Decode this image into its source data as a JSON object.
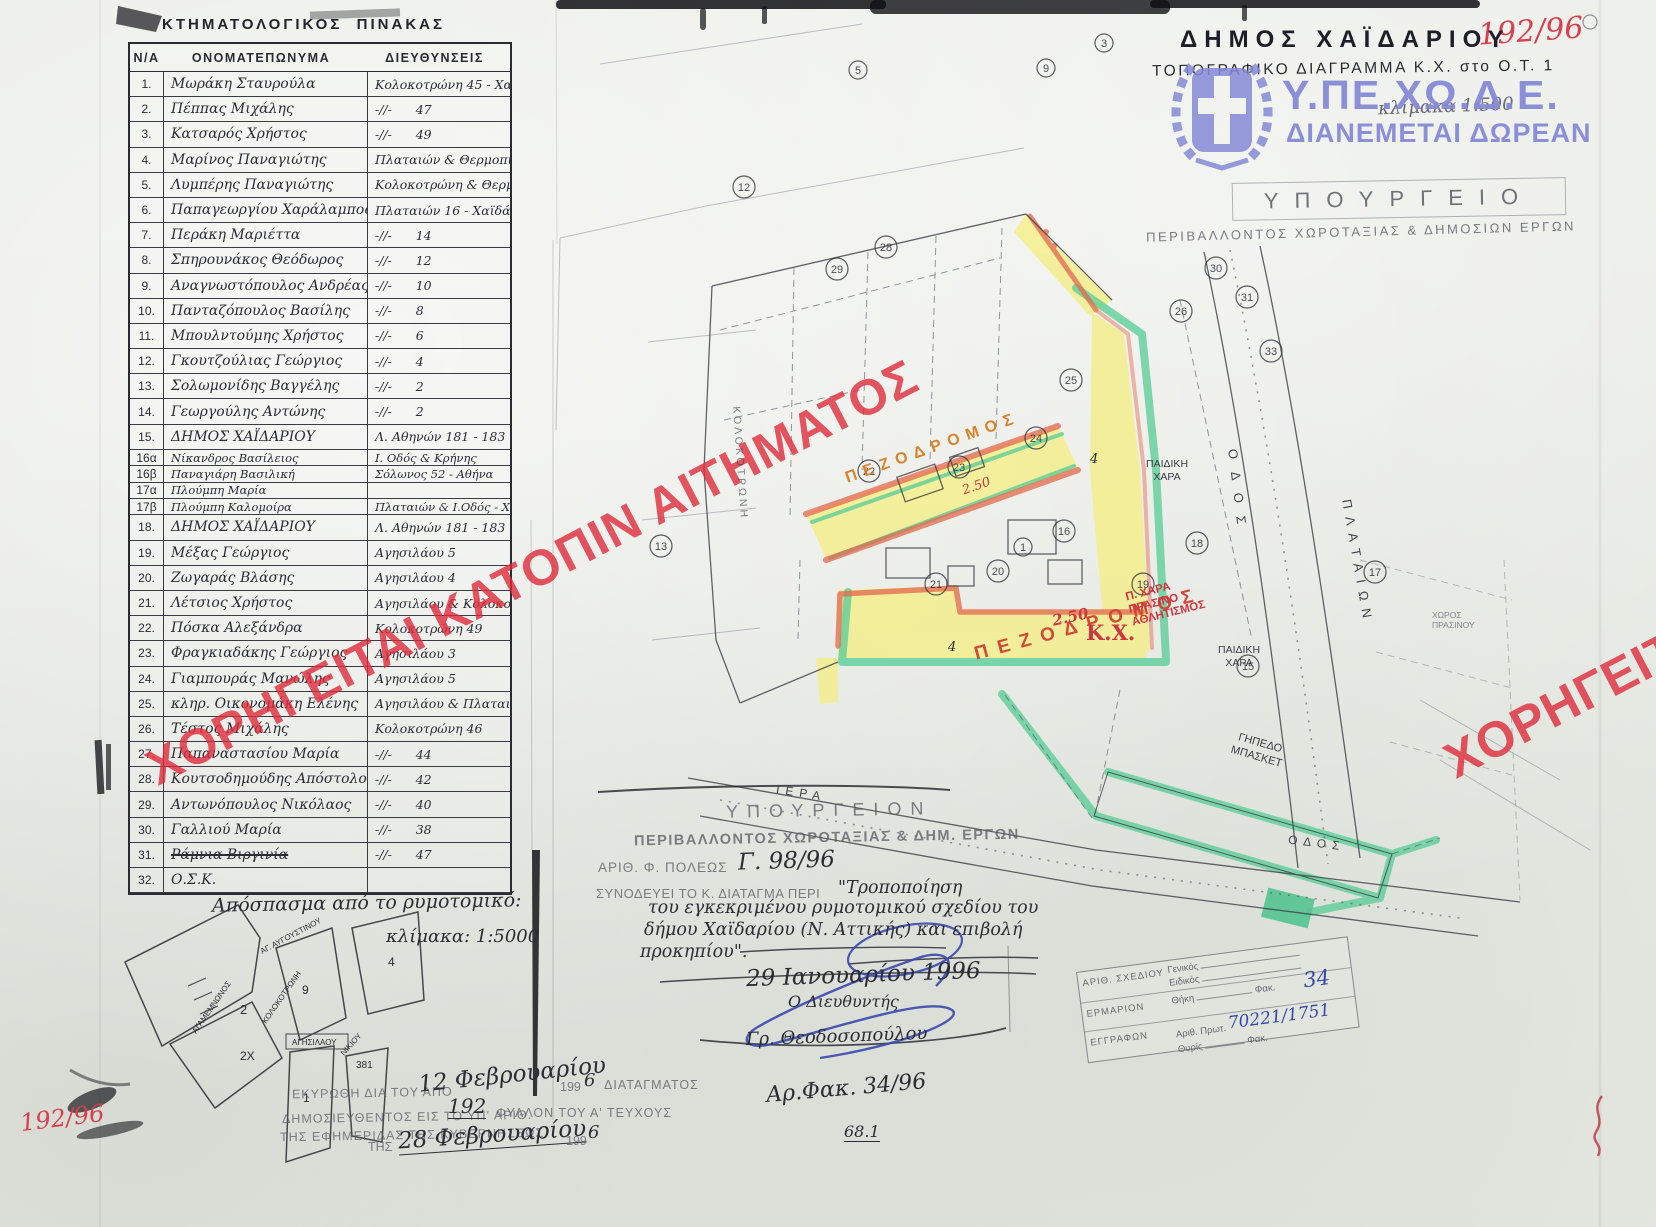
{
  "page": {
    "corner_number_top_right": "192/96",
    "corner_number_bottom_left": "192/96"
  },
  "table": {
    "title": "ΚΤΗΜΑΤΟΛΟΓΙΚΟΣ  ΠΙΝΑΚΑΣ",
    "columns": [
      "Ν/Α",
      "ΟΝΟΜΑΤΕΠΩΝΥΜΑ",
      "ΔΙΕΥΘΥΝΣΕΙΣ"
    ],
    "rows": [
      {
        "num": "1.",
        "name": "Μωράκη Σταυρούλα",
        "addr": "Κολοκοτρώνη 45 - Χαϊδάρι"
      },
      {
        "num": "2.",
        "name": "Πέππας Μιχάλης",
        "addr": "-//-      47"
      },
      {
        "num": "3.",
        "name": "Κατσαρός Χρήστος",
        "addr": "-//-      49"
      },
      {
        "num": "4.",
        "name": "Μαρίνος Παναγιώτης",
        "addr": "Πλαταιών & Θερμοπυλών"
      },
      {
        "num": "5.",
        "name": "Λυμπέρης Παναγιώτης",
        "addr": "Κολοκοτρώνη & Θερμοπυλών 3"
      },
      {
        "num": "6.",
        "name": "Παπαγεωργίου Χαράλαμπος",
        "addr": "Πλαταιών 16 - Χαϊδάρι"
      },
      {
        "num": "7.",
        "name": "Περάκη Μαριέττα",
        "addr": "-//-      14"
      },
      {
        "num": "8.",
        "name": "Σπηρουνάκος Θεόδωρος",
        "addr": "-//-      12"
      },
      {
        "num": "9.",
        "name": "Αναγνωστόπουλος Ανδρέας",
        "addr": "-//-      10"
      },
      {
        "num": "10.",
        "name": "Πανταζόπουλος Βασίλης",
        "addr": "-//-      8"
      },
      {
        "num": "11.",
        "name": "Μπουλντούμης Χρήστος",
        "addr": "-//-      6"
      },
      {
        "num": "12.",
        "name": "Γκουτζούλιας Γεώργιος",
        "addr": "-//-      4"
      },
      {
        "num": "13.",
        "name": "Σολωμονίδης Βαγγέλης",
        "addr": "-//-      2"
      },
      {
        "num": "14.",
        "name": "Γεωργούλης Αντώνης",
        "addr": "-//-      2"
      },
      {
        "num": "15.",
        "name": "ΔΗΜΟΣ ΧΑΪΔΑΡΙΟΥ",
        "addr": "Λ. Αθηνών 181 - 183"
      },
      {
        "num": "16α",
        "name": "Νίκανδρος Βασίλειος",
        "addr": "Ι. Οδός & Κρήνης",
        "small": true
      },
      {
        "num": "16β",
        "name": "Παναγιάρη Βασιλική",
        "addr": "Σόλωνος 52 - Αθήνα",
        "small": true
      },
      {
        "num": "17α",
        "name": "Πλούμπη Μαρία",
        "addr": "",
        "small": true
      },
      {
        "num": "17β",
        "name": "Πλούμπη Καλομοίρα",
        "addr": "Πλαταιών & Ι.Οδός - Χαϊδάρι",
        "small": true
      },
      {
        "num": "18.",
        "name": "ΔΗΜΟΣ ΧΑΪΔΑΡΙΟΥ",
        "addr": "Λ. Αθηνών 181 - 183"
      },
      {
        "num": "19.",
        "name": "Μέξας Γεώργιος",
        "addr": "Αγησιλάου 5"
      },
      {
        "num": "20.",
        "name": "Ζωγαράς Βλάσης",
        "addr": "Αγησιλάου 4"
      },
      {
        "num": "21.",
        "name": "Λέτσιος Χρήστος",
        "addr": "Αγησιλάου & Κολοκοτρώνη 5"
      },
      {
        "num": "22.",
        "name": "Πόσκα Αλεξάνδρα",
        "addr": "Κολοκοτρώνη 49"
      },
      {
        "num": "23.",
        "name": "Φραγκιαδάκης Γεώργιος",
        "addr": "Αγησιλάου 3"
      },
      {
        "num": "24.",
        "name": "Γιαμπουράς Μανώλης",
        "addr": "Αγησιλάου 5"
      },
      {
        "num": "25.",
        "name": "κληρ. Οικονομάκη Ελένης",
        "addr": "Αγησιλάου & Πλαταιών"
      },
      {
        "num": "26.",
        "name": "Τέστος Μιχάλης",
        "addr": "Κολοκοτρώνη 46"
      },
      {
        "num": "27.",
        "name": "Παπαναστασίου Μαρία",
        "addr": "-//-      44"
      },
      {
        "num": "28.",
        "name": "Κουτσοδημούδης Απόστολος",
        "addr": "-//-      42"
      },
      {
        "num": "29.",
        "name": "Αντωνόπουλος Νικόλαος",
        "addr": "-//-      40"
      },
      {
        "num": "30.",
        "name": "Γαλλιού Μαρία",
        "addr": "-//-      38"
      },
      {
        "num": "31.",
        "name": "Ράμνια Βιργινία",
        "addr": "-//-      47",
        "struck": true
      },
      {
        "num": "32.",
        "name": "Ο.Σ.Κ.",
        "addr": ""
      }
    ]
  },
  "title_block": {
    "municipality": "ΔΗΜΟΣ  ΧΑΪΔΑΡΙΟΥ",
    "subtitle": "ΤΟΠΟΓΡΑΦΙΚΟ  ΔΙΑΓΡΑΜΜΑ  Κ.Χ. στο Ο.Τ. 1",
    "scale": "κλίμακα 1:500"
  },
  "logo": {
    "agency": "Υ.ΠΕ.ΧΩ.Δ.Ε.",
    "tagline": "ΔΙΑΝΕΜΕΤΑΙ ΔΩΡΕΑΝ"
  },
  "ministry_stamp": {
    "line1": "ΥΠΟΥΡΓΕΙΟ",
    "line2": "ΠΕΡΙΒΑΛΛΟΝΤΟΣ  ΧΩΡΟΤΑΞΙΑΣ  &  ΔΗΜΟΣΙΩΝ  ΕΡΓΩΝ"
  },
  "watermark": {
    "main": "ΧΟΡΗΓΕΙΤΑΙ ΚΑΤΟΠΙΝ ΑΙΤΗΜΑΤΟΣ",
    "right": "ΧΟΡΗΓΕΙΤΑΙ"
  },
  "map": {
    "pedestrian1": "ΠΕΖΟΔΡΟΜΟΣ",
    "width_note1": "2.50",
    "pedestrian2": "ΠΕΖΟΔΡΟΜΟΣ",
    "width_note2": "2.50",
    "kx": "Κ.Χ.",
    "red_note_lines": [
      "Π. ΧΑΡΑ",
      "ΠΡΑΣΙΝΟ",
      "ΑΘΛΗΤΙΣΜΟΣ"
    ],
    "playground1_lines": [
      "ΠΑΙΔΙΚΗ",
      "ΧΑΡΑ"
    ],
    "playground2_lines": [
      "ΠΑΙΔΙΚΗ",
      "ΧΑΡΑ"
    ],
    "court_lines": [
      "ΓΗΠΕΔΟ",
      "ΜΠΑΣΚΕΤ"
    ],
    "street_right_1": "ΟΔΟΣ",
    "street_right_2": "ΠΛΑΤΑΙΩΝ",
    "street_bottom_1": "ΙΕΡΑ",
    "street_bottom_2": "ΟΔΟΣ",
    "street_left": "ΚΟΛΟΚΟΤΡΩΝΗ",
    "green_note_lines": [
      "ΧΩΡΟΣ",
      "ΠΡΑΣΙΝΟΥ"
    ],
    "dim_marks": [
      "4",
      "4"
    ],
    "parcel_numbers": [
      {
        "n": "28",
        "x": 886,
        "y": 247
      },
      {
        "n": "29",
        "x": 837,
        "y": 269
      },
      {
        "n": "22",
        "x": 869,
        "y": 471
      },
      {
        "n": "23",
        "x": 959,
        "y": 467
      },
      {
        "n": "24",
        "x": 1036,
        "y": 438
      },
      {
        "n": "25",
        "x": 1071,
        "y": 380
      },
      {
        "n": "26",
        "x": 1181,
        "y": 311
      },
      {
        "n": "16",
        "x": 1064,
        "y": 531
      },
      {
        "n": "1",
        "x": 1023,
        "y": 547
      },
      {
        "n": "21",
        "x": 936,
        "y": 584
      },
      {
        "n": "20",
        "x": 998,
        "y": 571
      },
      {
        "n": "19",
        "x": 1143,
        "y": 584
      },
      {
        "n": "18",
        "x": 1197,
        "y": 543
      },
      {
        "n": "15",
        "x": 1248,
        "y": 666
      },
      {
        "n": "17",
        "x": 1375,
        "y": 572
      },
      {
        "n": "5",
        "x": 858,
        "y": 70
      },
      {
        "n": "9",
        "x": 1046,
        "y": 68
      },
      {
        "n": "3",
        "x": 1104,
        "y": 43
      },
      {
        "n": "12",
        "x": 744,
        "y": 187
      },
      {
        "n": "13",
        "x": 661,
        "y": 546
      },
      {
        "n": "30",
        "x": 1216,
        "y": 268
      },
      {
        "n": "31",
        "x": 1247,
        "y": 297
      },
      {
        "n": "33",
        "x": 1271,
        "y": 351
      }
    ]
  },
  "decree_block": {
    "ministry_line1": "ΥΠΟΥΡΓΕΙΟΝ",
    "ministry_line2": "ΠΕΡΙΒΑΛΛΟΝΤΟΣ ΧΩΡΟΤΑΞΙΑΣ & ΔΗΜ. ΕΡΓΩΝ",
    "file_label": "ΑΡΙΘ. Φ. ΠΟΛΕΩΣ",
    "file_number": "Γ. 98/96",
    "accompanies": "ΣΥΝΟΔΕΥΕΙ ΤΟ Κ. ΔΙΑΤΑΓΜΑ ΠΕΡΙ",
    "quote_lines": [
      "\"Τροποποίηση",
      "του εγκεκριμένου ρυμοτομικού σχεδίου του",
      "δήμου Χαϊδαρίου (Ν. Αττικής) και επιβολή",
      "προκηπίου\"."
    ],
    "date": "29 Ιανουαρίου 1996",
    "signer_title": "Ο Διευθυντής",
    "signer_name": "Γρ. Θεοδοσοπούλου"
  },
  "inset": {
    "caption": "Απόσπασμα από το ρυμοτομικό:",
    "scale": "κλίμακα: 1:5000",
    "street_agamemnonos": "ΑΓΑΜΕΜΝΩΝΟΣ",
    "street_kolokotroni": "ΚΟΛΟΚΟΤΡΩΝΗ",
    "street_top_diag": "ΑΓ. ΑΥΓΟΥΣΤΙΝΟΥ",
    "street_agisilaou": "ΑΓΗΣΙΛΑΟΥ",
    "street_nikiou": "ΝΙΚΙΟΥ",
    "parcel_2": "2",
    "parcel_2x": "2Χ",
    "parcel_9": "9",
    "parcel_4": "4",
    "parcel_1": "1",
    "parcel_381": "381"
  },
  "filing_stamp": {
    "row1_label": "ΑΡΙΘ. ΣΧΕΔΙΟΥ",
    "row1_field_a": "Γενικός",
    "row1_field_b": "Ειδικός",
    "row2_label": "ΕΡΜΑΡΙΟΝ",
    "row2_field": "Θήκη",
    "row2_fak_label": "Φακ.",
    "row2_value": "34",
    "row3_label": "ΕΓΓΡΑΦΩΝ",
    "row3_field": "Αριθ. Πρωτ.",
    "row3_value": "70221/1751",
    "row3_sub": "Θυρίς",
    "row3_fak": "Φακ."
  },
  "publication_stamp": {
    "line1_prefix": "ΕΚΥΡΩΘΗ ΔΙΑ ΤΟΥ ΑΠΟ",
    "line1_hand": "12 Φεβρουαρίου",
    "line1_year_gray": "199",
    "line1_year_hand": "6",
    "line1_suffix": "ΔΙΑΤΑΓΜΑΤΟΣ",
    "line2_prefix": "ΔΗΜΟΣΙΕΥΘΕΝΤΟΣ ΕΙΣ ΤΟ ΥΠ' ΑΡΙΘ.",
    "line2_hand": "192",
    "line2_suffix": "ΦΥΛΛΟΝ ΤΟΥ Α' ΤΕΥΧΟΥΣ",
    "line3": "ΤΗΣ ΕΦΗΜΕΡΙΔΑΣ ΤΗΣ ΚΥΒΕΡΝΗΣΕΩΣ",
    "line4_prefix": "ΤΗΣ",
    "line4_hand": "28 Φεβρουαρίου",
    "line4_year_gray": "199",
    "line4_year_hand": "6"
  },
  "footer": {
    "file_ref": "Αρ.Φακ. 34/96",
    "page_mark": "68.1"
  },
  "colors": {
    "watermark_red": "#df2b3a",
    "highlight_yellow": "#f4ee8d",
    "highlight_green": "#5fce9a",
    "highlight_orange": "#e4684d",
    "logo_blue": "#8489d6",
    "hand_blue": "#3747ac",
    "red_ink": "#cf3540",
    "orange_ink": "#d9832c"
  }
}
